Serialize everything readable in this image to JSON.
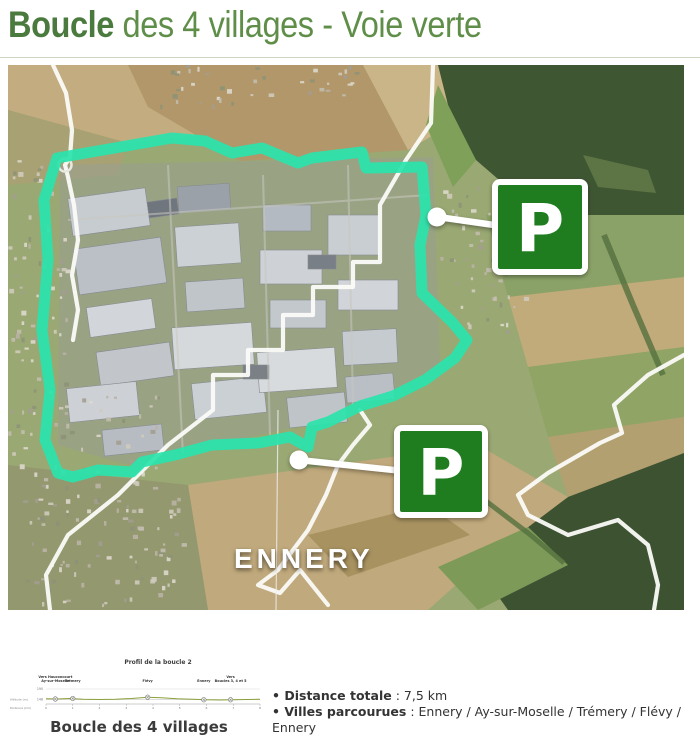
{
  "page": {
    "title_bold": "Boucle",
    "title_rest": " des 4 villages - Voie verte"
  },
  "colors": {
    "title_green": "#4a7a3d",
    "title_light_green": "#5f8e49",
    "route_teal": "#2be3ac",
    "parking_green": "#1f7d20",
    "callout_white": "#ffffff",
    "profile_line": "#8aa03c"
  },
  "map": {
    "town_label": "ENNERY",
    "parking_label": "P"
  },
  "figure": {
    "caption": "Boucle des 4 villages"
  },
  "chart_data": {
    "type": "line",
    "title": "Profil de la boucle 2",
    "xlabel": "Distance (km)",
    "ylabel": "Altitude (m)",
    "xlim": [
      0,
      8
    ],
    "ylim": [
      140,
      200
    ],
    "yticks": [
      190,
      148
    ],
    "xticks": [
      0,
      1,
      2,
      3,
      4,
      5,
      6,
      7,
      8
    ],
    "x": [
      0,
      0.4,
      0.9,
      1.4,
      2.0,
      2.6,
      3.2,
      3.8,
      4.3,
      4.9,
      5.5,
      6.0,
      6.5,
      7.0,
      7.5,
      8.0
    ],
    "y": [
      151,
      150,
      152,
      149,
      148,
      149,
      152,
      157,
      155,
      151,
      149,
      147,
      146,
      147,
      148,
      149
    ],
    "waypoints": [
      {
        "x": 0.35,
        "y": 150,
        "lines": [
          "Vers Hauconcourt",
          "Ay-sur-Moselle"
        ]
      },
      {
        "x": 1.0,
        "y": 152,
        "lines": [
          "Trémery"
        ]
      },
      {
        "x": 3.8,
        "y": 157,
        "lines": [
          "Flévy"
        ]
      },
      {
        "x": 5.9,
        "y": 147,
        "lines": [
          "Ennery"
        ]
      },
      {
        "x": 6.9,
        "y": 147,
        "lines": [
          "Vers",
          "Boucles 3, 4 et 5"
        ]
      }
    ],
    "legend": null,
    "grid": "horizontal-reference-lines"
  },
  "details": {
    "items": [
      {
        "label": "Distance totale",
        "value": " : 7,5 km"
      },
      {
        "label": "Villes parcourues",
        "value": " : Ennery / Ay-sur-Moselle / Trémery / Flévy / Ennery"
      }
    ]
  }
}
